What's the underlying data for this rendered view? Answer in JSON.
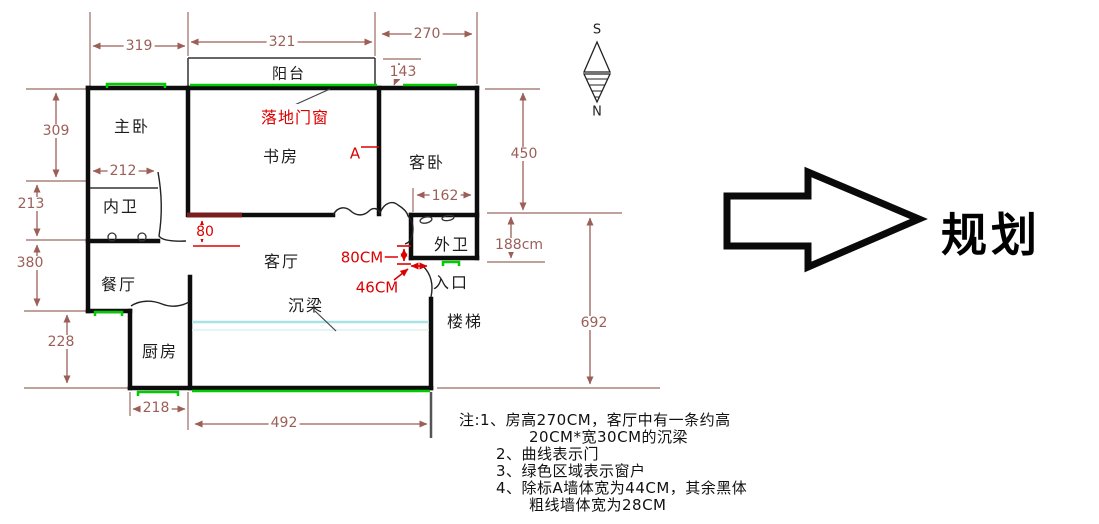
{
  "rooms": {
    "balcony": "阳台",
    "master_bedroom": "主卧",
    "study": "书房",
    "guest_bedroom": "客卧",
    "inner_bath": "内卫",
    "outer_bath": "外卫",
    "dining": "餐厅",
    "living": "客厅",
    "kitchen": "厨房",
    "entrance": "入口",
    "stairs": "楼梯"
  },
  "annotations": {
    "floor_door_window": "落地门窗",
    "wall_a_mark": "A",
    "beam": "沉梁",
    "seg_80": "80",
    "dim_80cm": "80CM",
    "dim_46cm": "46CM"
  },
  "dimensions": {
    "top_left": "319",
    "top_mid": "321",
    "top_right": "270",
    "balcony_offset": "143",
    "left_master": "309",
    "inner_bath_width": "212",
    "left_inner_bath": "213",
    "left_dining": "380",
    "left_kitchen": "228",
    "kitchen_width": "218",
    "bottom_width": "492",
    "right_upper": "450",
    "outer_bath_width": "162",
    "right_mid": "188cm",
    "right_total": "692"
  },
  "compass": {
    "top": "S",
    "bottom": "N"
  },
  "arrow_label": "规划",
  "notes": {
    "line1": "注:1、房高270CM，客厅中有一条约高",
    "line2": "20CM*宽30CM的沉梁",
    "line3": "2、曲线表示门",
    "line4": "3、绿色区域表示窗户",
    "line5": "4、除标A墙体宽为44CM，其余黑体",
    "line6": "粗线墙体宽为28CM"
  },
  "colors": {
    "wall": "#0d0d0d",
    "dimension": "#9b5f58",
    "annotation_red": "#dd0000",
    "window_green": "#00cc00",
    "beam_cyan": "#a9e3e5",
    "wall_a_maroon": "#7a1f1f"
  }
}
